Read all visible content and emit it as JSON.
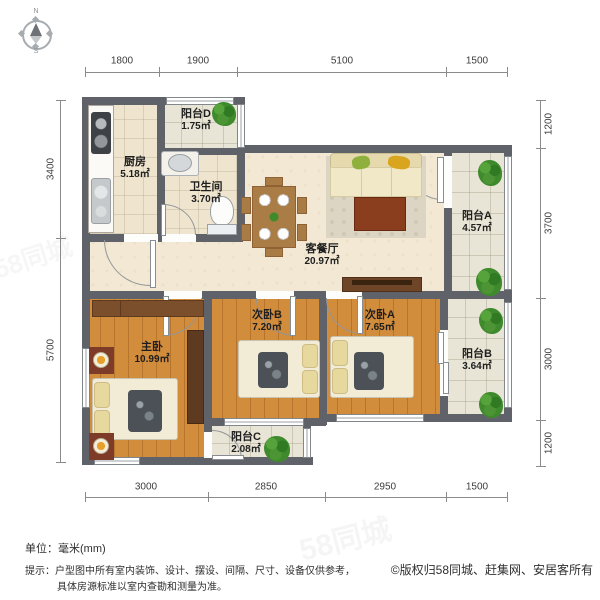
{
  "compass": {
    "north_label": "N",
    "south_label": "S"
  },
  "dimensions": {
    "top": [
      "1800",
      "1900",
      "5100",
      "1500"
    ],
    "bottom": [
      "3000",
      "2850",
      "2950",
      "1500"
    ],
    "left": [
      "3400",
      "5700"
    ],
    "right": [
      "1200",
      "3700",
      "3000",
      "1200"
    ]
  },
  "rooms": {
    "kitchen": {
      "name": "厨房",
      "area": "5.18㎡"
    },
    "balcony_d": {
      "name": "阳台D",
      "area": "1.75㎡"
    },
    "bathroom": {
      "name": "卫生间",
      "area": "3.70㎡"
    },
    "living_dining": {
      "name": "客餐厅",
      "area": "20.97㎡"
    },
    "balcony_a": {
      "name": "阳台A",
      "area": "4.57㎡"
    },
    "master_bedroom": {
      "name": "主卧",
      "area": "10.99㎡"
    },
    "bedroom_b": {
      "name": "次卧B",
      "area": "7.20㎡"
    },
    "bedroom_a": {
      "name": "次卧A",
      "area": "7.65㎡"
    },
    "balcony_b": {
      "name": "阳台B",
      "area": "3.64㎡"
    },
    "balcony_c": {
      "name": "阳台C",
      "area": "2.08㎡"
    }
  },
  "footer": {
    "unit_label": "单位：毫米(mm)",
    "tip_line1": "提示：户型图中所有室内装饰、设计、摆设、间隔、尺寸、设备仅供参考，",
    "tip_line2": "具体房源标准以室内查勘和测量为准。",
    "copyright": "©版权归58同城、赶集网、安居客所有"
  },
  "watermark": "58同城",
  "colors": {
    "wall": "#5F6369",
    "floor-wood": "#D18C3C",
    "floor-living": "#F3E8D3",
    "floor-tile": "#EFE5CF",
    "floor-balcony": "#E9E5D6",
    "plant-green": "#3E8A2D",
    "accent-orange": "#E8A02A"
  }
}
